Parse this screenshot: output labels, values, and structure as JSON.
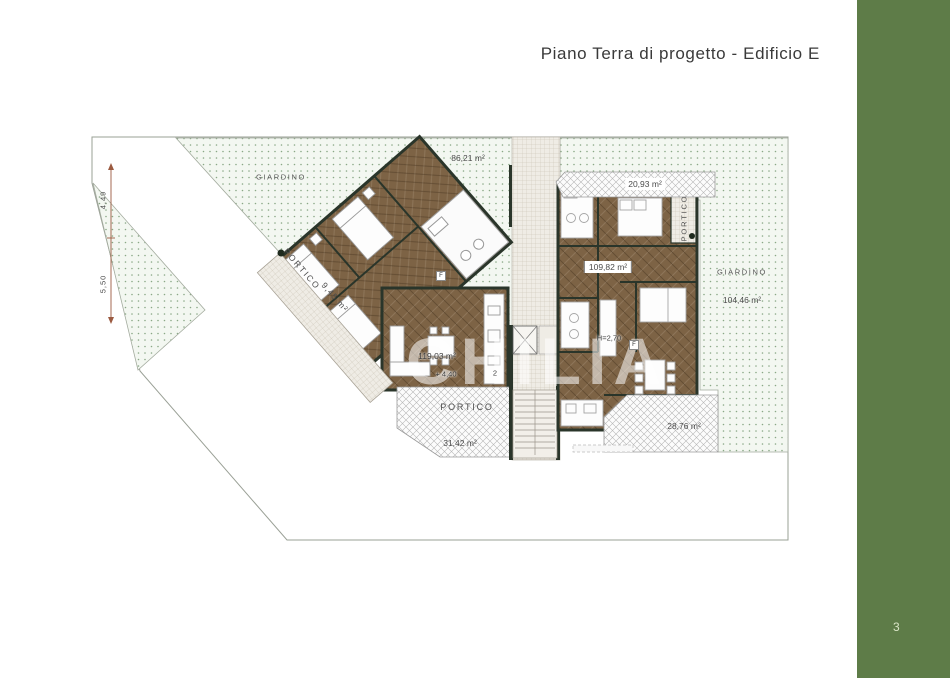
{
  "page": {
    "title": "Piano Terra di progetto - Edificio E",
    "page_number": "3"
  },
  "colors": {
    "accent_green": "#5e7c48",
    "wall": "#2a352a",
    "wood_floor": "#7d6345",
    "garden_dot": "#8aa886",
    "hatch_gray": "#b7b7b7",
    "dimension_line": "#9b5a40"
  },
  "plan": {
    "watermark": "CHILIA",
    "appliance_label": "F",
    "labels": {
      "garden_left": "GIARDINO",
      "garden_top_area": "86,21 m²",
      "portico_left": "PORTICO",
      "portico_left_area": "9,45 m²",
      "unit_left_area": "119,03 m²",
      "unit_left_level": "+ 4,40",
      "unit_left_number": "2",
      "portico_bottom": "PORTICO",
      "portico_bottom_area": "31,42 m²",
      "portico_top_right_area": "20,93 m²",
      "portico_right": "PORTICO",
      "unit_right_area": "109,82 m²",
      "unit_right_height": "H=2,70",
      "garden_right": "GIARDINO",
      "garden_right_area": "104,46 m²",
      "portico_bottom_right_area": "28,76 m²",
      "dim_upper": "4,49",
      "dim_lower": "5,50"
    }
  }
}
